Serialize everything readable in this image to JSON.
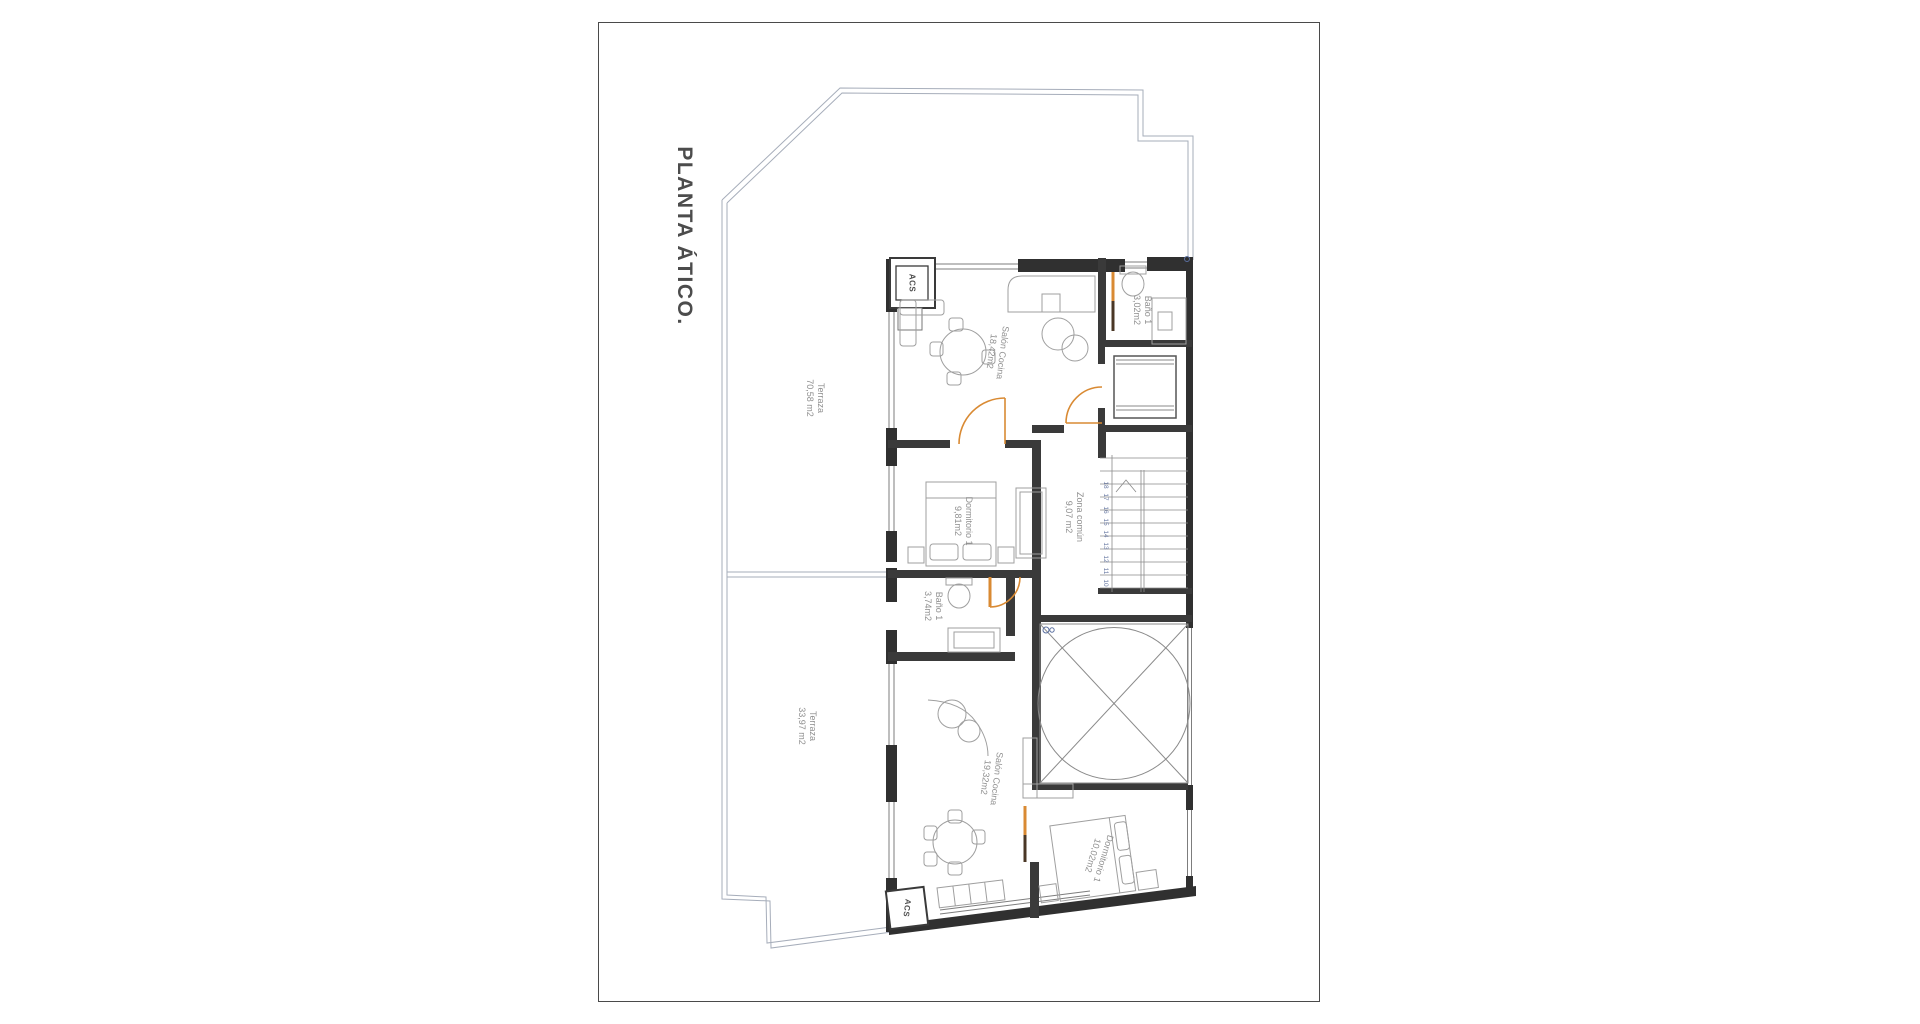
{
  "title": "PLANTA ÁTICO.",
  "rooms": {
    "terraza_upper": {
      "name": "Terraza",
      "area": "70,58 m2"
    },
    "salon_cocina_1": {
      "name": "Salón Cocina",
      "area": "18,42m2"
    },
    "bano_1_top": {
      "name": "Baño 1",
      "area": "3,02m2"
    },
    "dormitorio_1_top": {
      "name": "Dormitorio 1",
      "area": "9,81m2"
    },
    "zona_comun": {
      "name": "Zona común",
      "area": "9,07 m2"
    },
    "bano_1_bottom": {
      "name": "Baño 1",
      "area": "3,74m2"
    },
    "terraza_lower": {
      "name": "Terraza",
      "area": "33,97 m2"
    },
    "salon_cocina_2": {
      "name": "Salón Cocina",
      "area": "19,32m2"
    },
    "dormitorio_1_bottom": {
      "name": "Dormitorio 1",
      "area": "10,02m2"
    }
  },
  "labels": {
    "acs_top": "ACS",
    "acs_bottom": "ACS"
  },
  "stairs": {
    "steps": [
      "10",
      "11",
      "12",
      "13",
      "14",
      "15",
      "16",
      "17",
      "18"
    ]
  },
  "colors": {
    "wall": "#303030",
    "railing": "#a6adba",
    "door": "#d98a33",
    "door_dark": "#4a3726",
    "stair_number": "#6b7ba4",
    "room_label": "#8f8f8f",
    "title": "#4c4c4c",
    "furniture": "#9f9f9f"
  }
}
